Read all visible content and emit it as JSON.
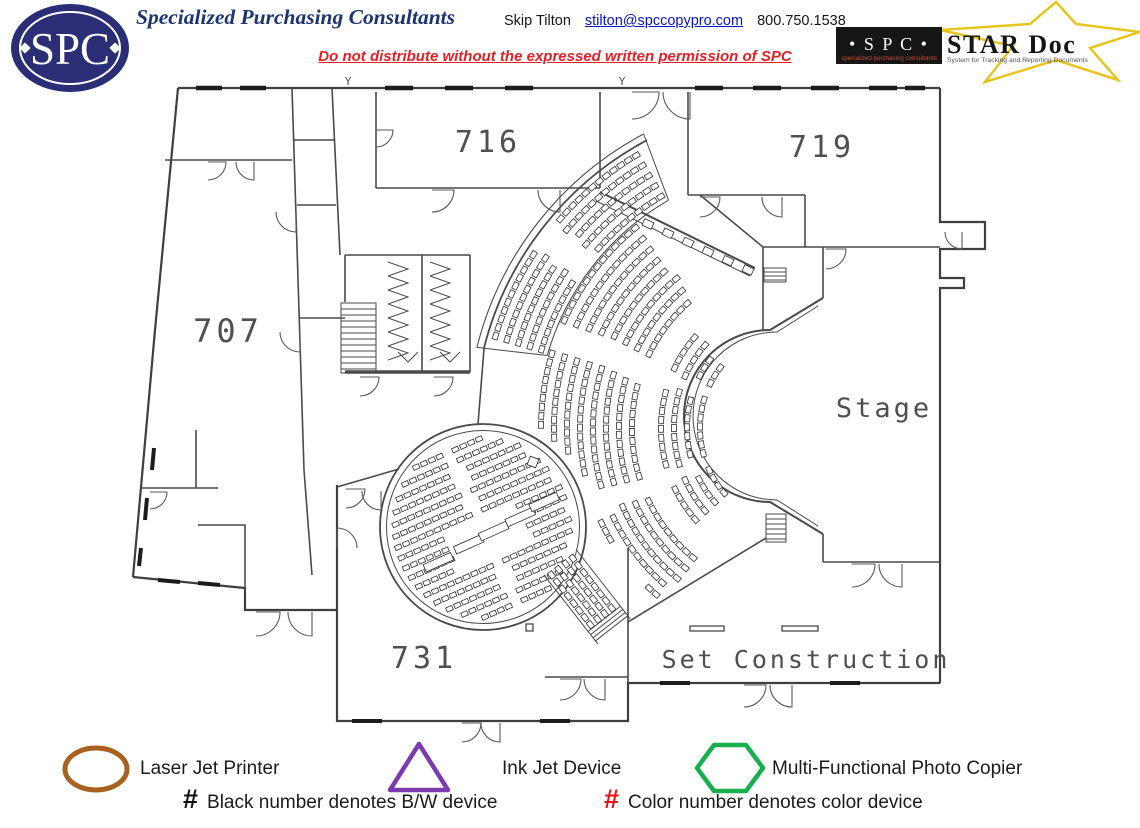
{
  "header": {
    "logo_text": "SPC",
    "company": "Specialized Purchasing Consultants",
    "contact": {
      "name": "Skip Tilton",
      "email": "stilton@spccopypro.com",
      "phone": "800.750.1538"
    },
    "notice": "Do not distribute without the expressed written permission of SPC",
    "stardoc": {
      "box_text": "• S P C •",
      "box_tagline": "specialized purchasing consultants",
      "title": "STAR Doc",
      "tagline": "System for Tracking and Reporting Documents"
    },
    "colors": {
      "logo_navy": "#2b2d77",
      "title_navy": "#1d3473",
      "link_blue": "#0a14c8",
      "notice_red": "#e61e25",
      "star_yellow": "#e7c51f"
    }
  },
  "floorplan": {
    "rooms": {
      "r707": "707",
      "r716": "716",
      "r719": "719",
      "r731": "731",
      "stage": "Stage",
      "set_construction": "Set Construction"
    },
    "grid_marks": [
      "Y",
      "Y"
    ]
  },
  "legend": {
    "items": [
      {
        "shape": "ellipse",
        "color": "#a8611f",
        "label": "Laser Jet Printer"
      },
      {
        "shape": "triangle",
        "color": "#7b3bae",
        "label": "Ink Jet Device"
      },
      {
        "shape": "hexagon",
        "color": "#16b04f",
        "label": "Multi-Functional Photo Copier"
      }
    ],
    "notes": [
      {
        "symbol": "#",
        "symbol_color": "#111111",
        "text": "Black number denotes B/W device"
      },
      {
        "symbol": "#",
        "symbol_color": "#ee1111",
        "text": "Color number denotes color device"
      }
    ]
  }
}
